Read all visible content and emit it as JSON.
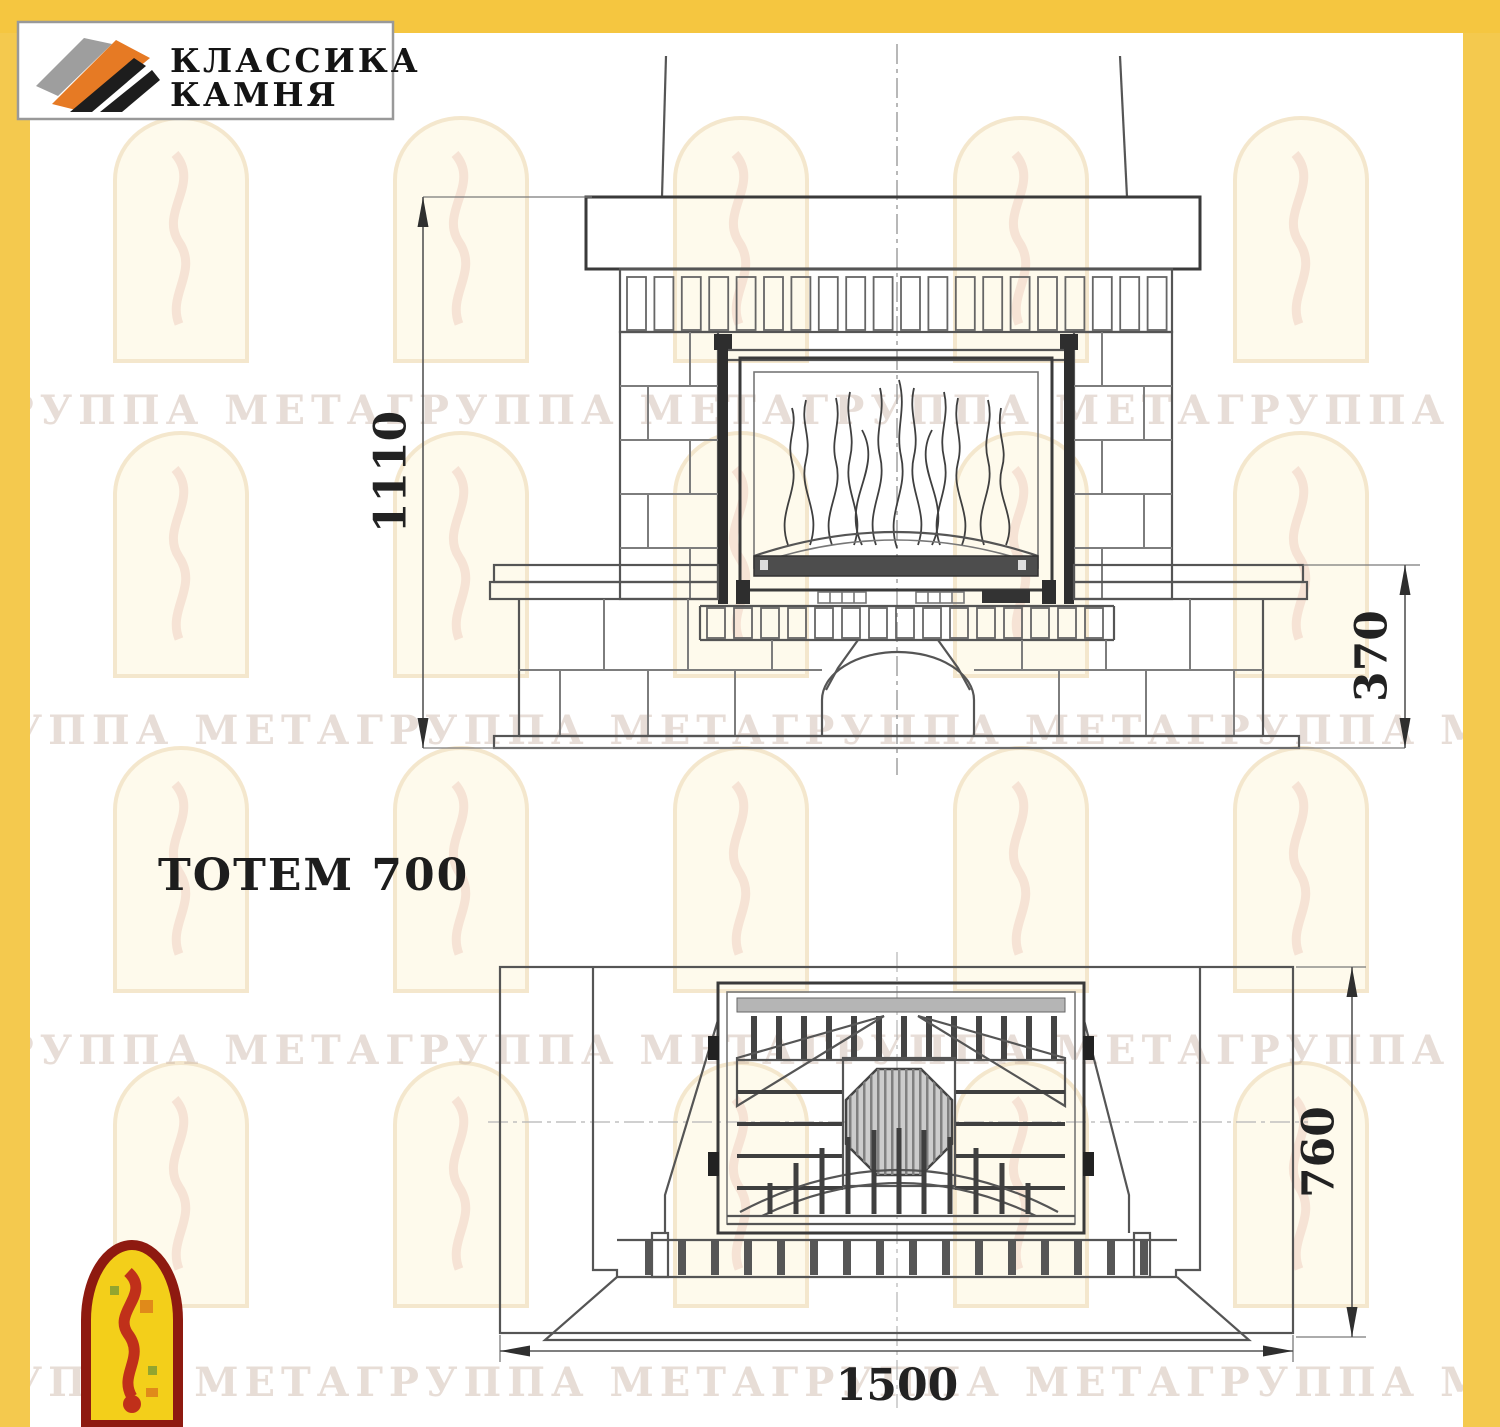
{
  "title": "ТОТЕМ 700",
  "logo": {
    "line1": "КЛАССИКА",
    "line2": "КАМНЯ"
  },
  "watermark": {
    "row_text": "ГРУППА МЕТАГРУППА МЕТАГРУППА МЕТАГРУППА МЕТАГРУППА МЕТА"
  },
  "front_view": {
    "dim_height": "1110",
    "dim_base_height": "370"
  },
  "plan_view": {
    "dim_depth": "760",
    "dim_width": "1500"
  },
  "colors": {
    "accent_yellow": "#F5C640",
    "line_dark": "#3a3a3a",
    "logo_orange": "#E67A24",
    "footer_logo_red": "#C0301A",
    "footer_logo_yellow": "#F3CF1A",
    "footer_logo_border": "#8E1A10"
  }
}
